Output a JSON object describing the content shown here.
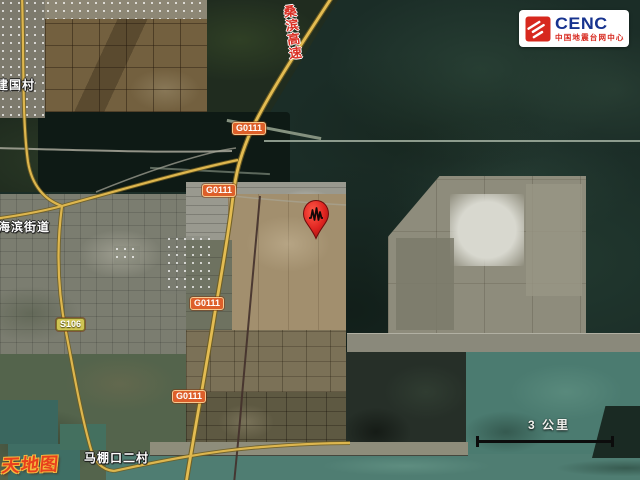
{
  "branding": {
    "cenc_logo": {
      "acronym": "CENC",
      "full_name": "中国地震台网中心",
      "icon": "cenc-red-stripes-icon",
      "accent_blue": "#17338f",
      "accent_red": "#d7281e"
    }
  },
  "map": {
    "type": "satellite-basemap-with-epicenter-overlay",
    "epicenter_marker": {
      "icon": "epicenter-pin-icon",
      "color": "#d42020"
    },
    "place_labels": [
      {
        "text": "建国村"
      },
      {
        "text": "海滨街道"
      },
      {
        "text": "马棚口二村"
      }
    ],
    "road_badges": [
      {
        "label": "G0111"
      },
      {
        "label": "G0111"
      },
      {
        "label": "G0111"
      },
      {
        "label": "G0111"
      },
      {
        "label": "S106"
      }
    ],
    "expressway_label": {
      "text": "桑滨高速",
      "chars": [
        "桑",
        "滨",
        "高",
        "速"
      ]
    },
    "scale_bar": {
      "label": "3 公里"
    },
    "watermark": {
      "text": "天地图"
    },
    "road_colors": {
      "highway_fill": "#e3bc52",
      "badge_national": "#dd5f2a",
      "badge_provincial": "#cfc453"
    }
  }
}
